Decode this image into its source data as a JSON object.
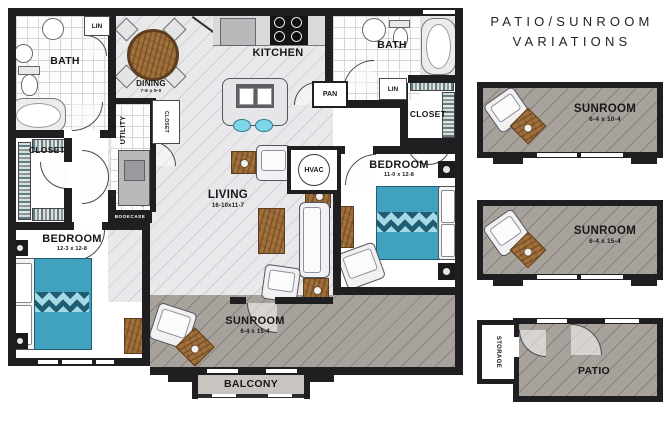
{
  "palette": {
    "wall": "#1f1f21",
    "floor-light": "#e9e9ec",
    "floor-dark": "#a8a29c",
    "balcony": "#c8c5c1",
    "bed": "#41a2c0",
    "bed-zig": "#1f5d74",
    "wood": "#a0713d",
    "wood-dark": "#5d3d1c",
    "stool": "#7fd6e8",
    "ink": "#18181a"
  },
  "panel": {
    "title_line1": "PATIO/SUNROOM",
    "title_line2": "VARIATIONS"
  },
  "rooms": {
    "bath_left": {
      "label": "BATH"
    },
    "lin_left": {
      "label": "LIN"
    },
    "dining": {
      "label": "DINING",
      "dims": "7-8 x 9-0"
    },
    "kitchen": {
      "label": "KITCHEN"
    },
    "pantry": {
      "label": "PAN"
    },
    "bath_right": {
      "label": "BATH"
    },
    "lin_right": {
      "label": "LIN"
    },
    "closet_right": {
      "label": "CLOSET"
    },
    "closet_left": {
      "label": "CLOSET"
    },
    "closet_hall": {
      "label": "CLOSET"
    },
    "utility": {
      "label": "UTILITY"
    },
    "bookcase": {
      "label": "BOOKCASE"
    },
    "hvac": {
      "label": "HVAC"
    },
    "living": {
      "label": "LIVING",
      "dims": "16-10x11-7"
    },
    "bedroom_left": {
      "label": "BEDROOM",
      "dims": "12-3 x 12-8"
    },
    "bedroom_right": {
      "label": "BEDROOM",
      "dims": "11-0 x 12-8"
    },
    "sunroom": {
      "label": "SUNROOM",
      "dims": "6-4 x 15-4"
    },
    "balcony": {
      "label": "BALCONY"
    }
  },
  "variations": [
    {
      "label": "SUNROOM",
      "dims": "6-4 x 10-4"
    },
    {
      "label": "SUNROOM",
      "dims": "6-4 x 15-4"
    },
    {
      "label": "PATIO",
      "storage_label": "STORAGE"
    }
  ]
}
